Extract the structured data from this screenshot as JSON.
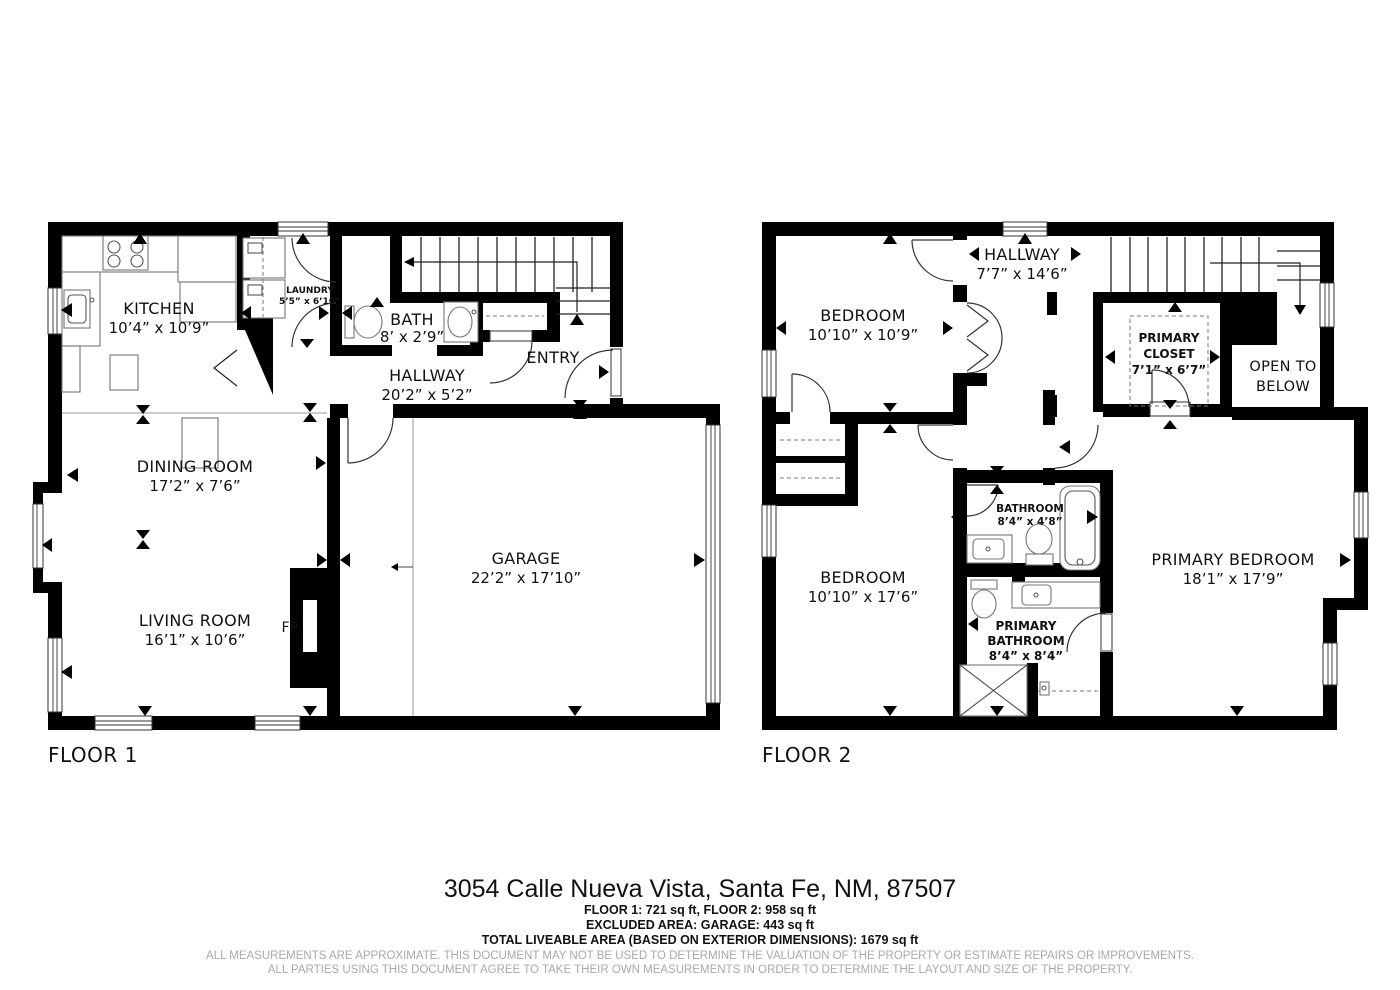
{
  "floor1": {
    "label": "FLOOR 1",
    "kitchen_name": "KITCHEN",
    "kitchen_dims": "10’4” x 10’9”",
    "laundry_name": "LAUNDRY",
    "laundry_dims": "5’5” x 6’10”",
    "bath_name": "BATH",
    "bath_dims": "8’ x 2’9”",
    "hallway_name": "HALLWAY",
    "hallway_dims": "20’2” x 5’2”",
    "entry_name": "ENTRY",
    "dining_name": "DINING ROOM",
    "dining_dims": "17’2” x 7’6”",
    "living_name": "LIVING ROOM",
    "living_dims": "16’1” x 10’6”",
    "garage_name": "GARAGE",
    "garage_dims": "22’2” x 17’10”",
    "fireplace_label": "FP"
  },
  "floor2": {
    "label": "FLOOR 2",
    "hallway_name": "HALLWAY",
    "hallway_dims": "7’7” x 14’6”",
    "bedroom1_name": "BEDROOM",
    "bedroom1_dims": "10’10” x 10’9”",
    "primary_closet_line1": "PRIMARY",
    "primary_closet_line2": "CLOSET",
    "primary_closet_dims": "7’1” x 6’7”",
    "open_below_line1": "OPEN TO",
    "open_below_line2": "BELOW",
    "bathroom_name": "BATHROOM",
    "bathroom_dims": "8’4” x 4’8”",
    "bedroom2_name": "BEDROOM",
    "bedroom2_dims": "10’10” x 17’6”",
    "primary_bathroom_line1": "PRIMARY",
    "primary_bathroom_line2": "BATHROOM",
    "primary_bathroom_dims": "8’4” x 8’4”",
    "primary_bedroom_name": "PRIMARY BEDROOM",
    "primary_bedroom_dims": "18’1” x 17’9”"
  },
  "footer": {
    "address": "3054 Calle Nueva Vista, Santa Fe, NM, 87507",
    "floor_areas": "FLOOR 1: 721 sq ft, FLOOR 2: 958 sq ft",
    "excluded_area": "EXCLUDED AREA: GARAGE: 443 sq ft",
    "total_area": "TOTAL LIVEABLE AREA (BASED ON EXTERIOR DIMENSIONS): 1679 sq ft",
    "disclaimer_line1": "ALL MEASUREMENTS ARE APPROXIMATE. THIS DOCUMENT MAY NOT BE USED TO DETERMINE THE VALUATION OF THE PROPERTY OR ESTIMATE REPAIRS OR IMPROVEMENTS.",
    "disclaimer_line2": "ALL PARTIES USING THIS DOCUMENT AGREE TO TAKE THEIR OWN MEASUREMENTS IN ORDER TO DETERMINE THE LAYOUT AND SIZE OF THE PROPERTY."
  }
}
